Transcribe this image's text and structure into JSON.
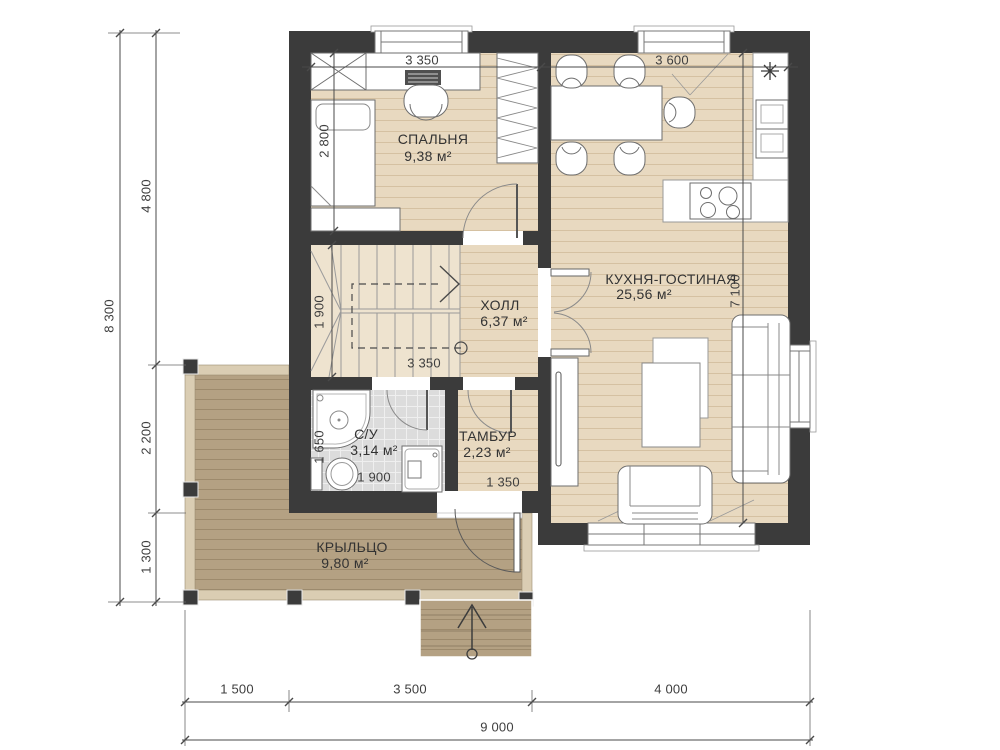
{
  "rooms": {
    "bedroom": {
      "name": "СПАЛЬНЯ",
      "area": "9,38 м²"
    },
    "kitchen_living": {
      "name": "КУХНЯ-ГОСТИНАЯ",
      "area": "25,56 м²"
    },
    "hall": {
      "name": "ХОЛЛ",
      "area": "6,37 м²"
    },
    "bathroom": {
      "name": "С/У",
      "area": "3,14 м²"
    },
    "vestibule": {
      "name": "ТАМБУР",
      "area": "2,23 м²"
    },
    "porch": {
      "name": "КРЫЛЬЦО",
      "area": "9,80 м²"
    }
  },
  "dims": {
    "left_total": "8 300",
    "left_top": "4 800",
    "left_mid": "2 200",
    "left_bottom": "1 300",
    "bottom_left": "1 500",
    "bottom_mid": "3 500",
    "bottom_right": "4 000",
    "bottom_total": "9 000",
    "top_bedroom": "3 350",
    "top_kitchen": "3 600",
    "bedroom_depth": "2 800",
    "stairs_depth": "1 900",
    "hall_width": "3 350",
    "kitchen_depth": "7 100",
    "bathroom_depth": "1 650",
    "bathroom_width": "1 900",
    "vestibule_width": "1 350"
  },
  "icons": {
    "vent_marker": "snowflake-icon",
    "stair_direction": "up-arrow-icon",
    "entry_direction": "up-arrow-icon"
  },
  "colors": {
    "wall": "#3b3b3b",
    "floor": "#e8d9c0",
    "floor_line": "#d5c1a2",
    "tile": "#dcdcdc",
    "porch_deck": "#b4a183",
    "porch_line": "#9d8a6c",
    "porch_trim": "#dacdb3",
    "dim_line": "#4a4a4a",
    "text": "#333333"
  }
}
